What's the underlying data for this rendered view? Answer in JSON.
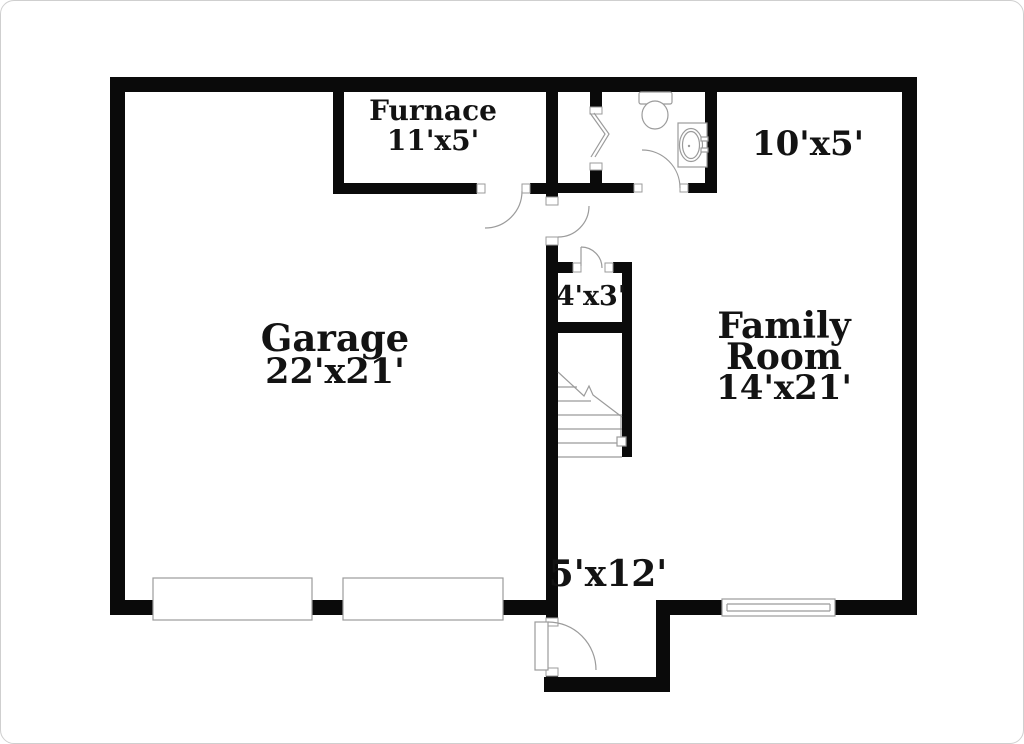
{
  "colors": {
    "page_bg": "#ffffff",
    "frame_border": "#cfcfcf",
    "wall": "#0a0a0a",
    "fixture_line": "#9b9b9b",
    "text": "#131313"
  },
  "floorplan": {
    "type": "residential-floor-plan",
    "rooms": {
      "furnace": {
        "label": "Furnace",
        "dims": "11'x5'"
      },
      "bathroom": {
        "dims": "10'x5'"
      },
      "garage": {
        "label": "Garage",
        "dims": "22'x21'"
      },
      "family_room": {
        "label_line1": "Family",
        "label_line2": "Room",
        "dims": "14'x21'"
      },
      "closet": {
        "dims": "4'x3'"
      },
      "entry_hall": {
        "dims": "5'x12'"
      }
    },
    "fixtures": [
      "toilet",
      "sink-vanity",
      "bifold-door",
      "stairs",
      "garage-door",
      "garage-door",
      "window",
      "entry-door",
      "swing-door-furnace",
      "swing-door-bathroom",
      "swing-door-hall",
      "swing-door-closet"
    ]
  }
}
